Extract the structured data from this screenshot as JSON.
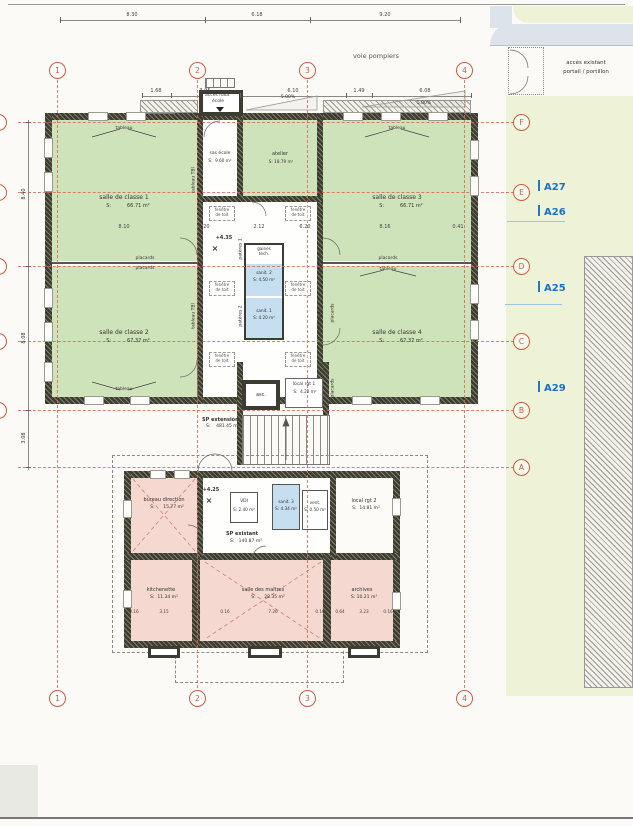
{
  "site": {
    "voie_pompiers": "voie pompiers",
    "acces_existant_l1": "accès existant",
    "acces_existant_l2": "portail / portillon",
    "acces_haut_l1": "accès haut",
    "acces_haut_l2": "école",
    "slope1": "5.00%",
    "slope2": "5.00%"
  },
  "grid": {
    "cols": [
      "1",
      "2",
      "3",
      "4"
    ],
    "rows": [
      "F",
      "E",
      "D",
      "C",
      "B",
      "A"
    ]
  },
  "refs": {
    "a27": "A27",
    "a26": "A26",
    "a25": "A25",
    "a29": "A29"
  },
  "levels": {
    "upper": "+4.35",
    "lower": "+4.25",
    "mark": "×"
  },
  "rooms": {
    "classe1": {
      "name": "salle de classe 1",
      "area": "S:          66.71 m²"
    },
    "classe2": {
      "name": "salle de classe 2",
      "area": "S:          67.37 m²"
    },
    "classe3": {
      "name": "salle de classe 3",
      "area": "S:          66.71 m²"
    },
    "classe4": {
      "name": "salle de classe 4",
      "area": "S:          67.37 m²"
    },
    "sas": {
      "name": "sas école",
      "area": "S:  9.60 m²"
    },
    "atelier": {
      "name": "atelier",
      "area": "S: 18.79 m²"
    },
    "gaines": {
      "name": "gaines\ntech."
    },
    "sanit2": {
      "name": "sanit. 2",
      "area": "S: 4.50 m²"
    },
    "sanit1": {
      "name": "sanit. 1",
      "area": "S: 4.20 m²"
    },
    "local1": {
      "name": "local rgt 1",
      "area": "S:  4.22 m²"
    },
    "asc": {
      "name": "asc."
    },
    "sp_extension": {
      "name": "SP extension",
      "area": "S:    481.45 m²"
    },
    "bureau": {
      "name": "bureau direction",
      "area": "S:      15.77 m²"
    },
    "vdi": {
      "name": "VDI",
      "area": "S: 2.40 m²"
    },
    "sanit3": {
      "name": "sanit. 3",
      "area": "S: 4.34 m²"
    },
    "vent": {
      "name": "vent.",
      "area": "S: 0.50 m²"
    },
    "local2": {
      "name": "local rgt 2",
      "area": "S:  14.81 m²"
    },
    "sp_existant": {
      "name": "SP existant",
      "area": "S:   140.87 m²"
    },
    "kitchenette": {
      "name": "kitchenette",
      "area": "S:  11.34 m²"
    },
    "maitres": {
      "name": "salle des maîtres",
      "area": "S:      28.35 m²"
    },
    "archives": {
      "name": "archives",
      "area": "S: 10.21 m²"
    }
  },
  "labels": {
    "tableau": "tableau",
    "placards": "placards",
    "tbi": "tableau TBI",
    "fenetre": "fenêtre\nde toit",
    "p1": "patères 1",
    "p2": "patères 2",
    "p3": "patères 3",
    "p4": "patères 4"
  },
  "dims": {
    "top": [
      "8.30",
      "6.18",
      "9.20"
    ],
    "roof": [
      "1.68",
      "3.95",
      "6.10",
      "1.49",
      "6.08"
    ],
    "mid": [
      "8.10",
      "6.20",
      "2.12",
      "6.20",
      "8.16",
      "0.41"
    ],
    "left": [
      "8.40",
      "8.08",
      "3.08"
    ],
    "lower": [
      "0.16",
      "3.15",
      "0.64",
      "0.16",
      "7.26",
      "0.16",
      "0.64",
      "3.23",
      "0.16"
    ]
  },
  "colors": {
    "room_green": "#cfe3bb",
    "room_pink": "#f5d8d0",
    "room_blue": "#c5dff0",
    "site_yellow": "#eef2d6",
    "road_gray": "#dde3ea",
    "grid_red": "#d86a52",
    "ref_blue": "#1b6fc8",
    "wall_dark": "#3c3c33"
  }
}
